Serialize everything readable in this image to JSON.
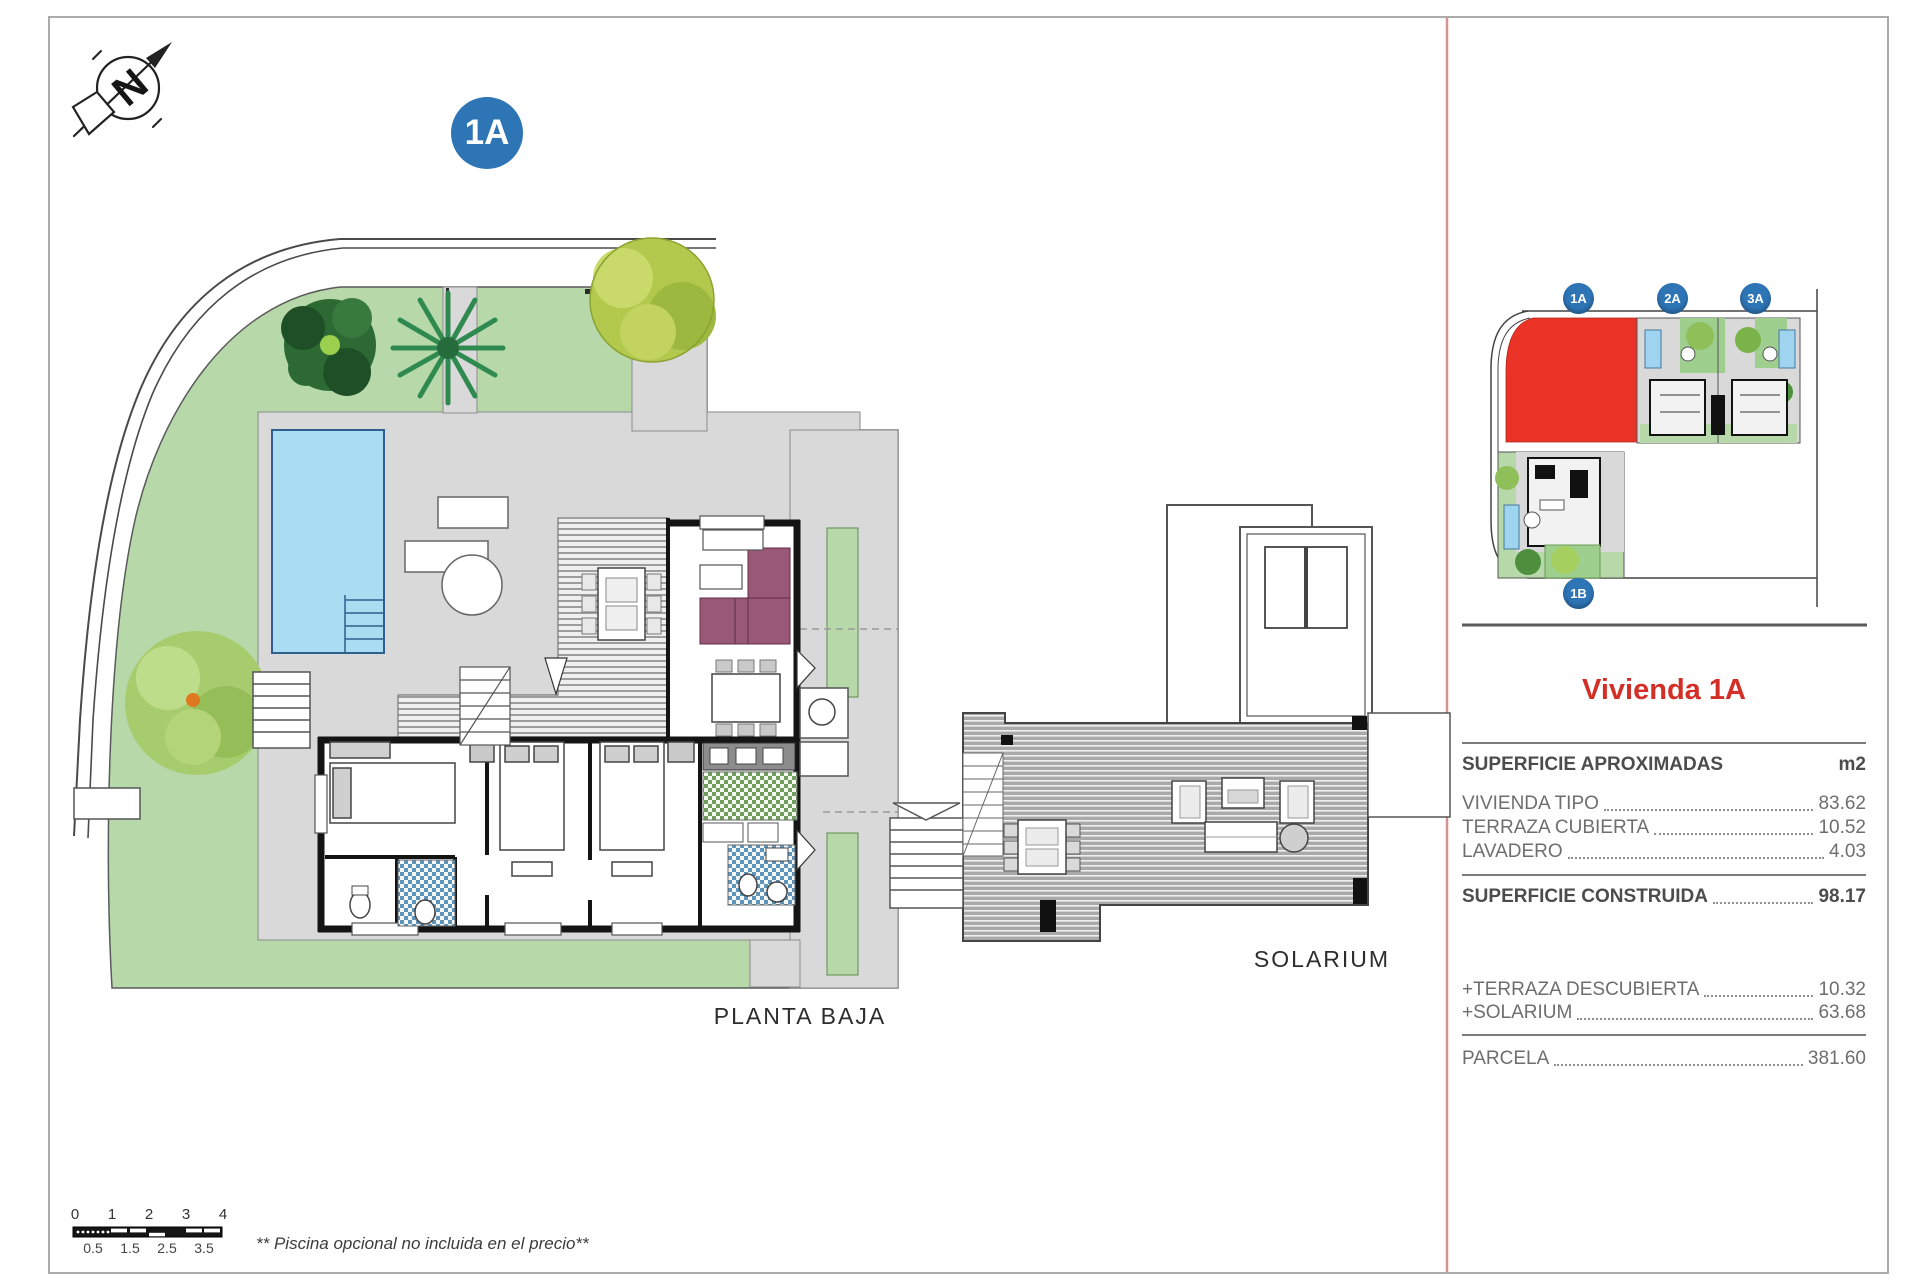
{
  "compass": {
    "letter": "N"
  },
  "main_badge": "1A",
  "labels": {
    "planta_baja": "PLANTA BAJA",
    "solarium": "SOLARIUM"
  },
  "key_plan": {
    "badge_1a": "1A",
    "badge_2a": "2A",
    "badge_3a": "3A",
    "badge_1b": "1B",
    "highlight_color": "#ea3326"
  },
  "panel": {
    "title": "Vivienda 1A",
    "title_color": "#d42f26",
    "surface_header": {
      "label": "SUPERFICIE APROXIMADAS",
      "unit": "m2"
    },
    "rows": [
      {
        "label": "VIVIENDA TIPO",
        "value": "83.62"
      },
      {
        "label": "TERRAZA CUBIERTA",
        "value": "10.52"
      },
      {
        "label": "LAVADERO",
        "value": "4.03"
      }
    ],
    "construida": {
      "label": "SUPERFICIE CONSTRUIDA",
      "value": "98.17"
    },
    "extras": [
      {
        "label": "+TERRAZA DESCUBIERTA",
        "value": "10.32"
      },
      {
        "label": "+SOLARIUM",
        "value": "63.68"
      }
    ],
    "parcela": {
      "label": "PARCELA",
      "value": "381.60"
    }
  },
  "scale_bar": {
    "top": [
      "0",
      "1",
      "2",
      "3",
      "4"
    ],
    "bottom": [
      "0.5",
      "1.5",
      "2.5",
      "3.5"
    ]
  },
  "footnote": "** Piscina opcional no incluida en el precio**",
  "colors": {
    "badge_blue": "#2e75b6",
    "divider_pink": "#d49490",
    "garden_green": "#b7d9aa",
    "pool_blue": "#aadcf2"
  }
}
